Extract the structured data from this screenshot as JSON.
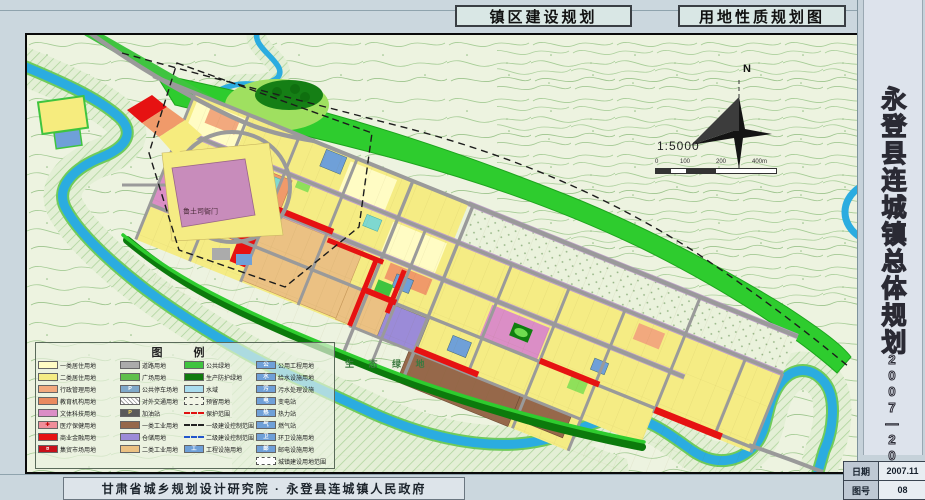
{
  "titles": {
    "primary": "镇区建设规划",
    "secondary": "用地性质规划图"
  },
  "side_panel": {
    "title": "永登县连城镇总体规划",
    "years": "2007—2020"
  },
  "info_table": {
    "date_label": "日期",
    "date_value": "2007.11",
    "no_label": "图号",
    "no_value": "08"
  },
  "footer": {
    "text": "甘肃省城乡规划设计研究院 · 永登县连城镇人民政府"
  },
  "map": {
    "labels": {
      "eco_green": "生 态 绿 地",
      "yamen": "鲁土司衙门",
      "north": "N",
      "scale_ratio": "1:5000"
    },
    "scale_ticks": [
      "0",
      "100",
      "200",
      "400m"
    ]
  },
  "legend": {
    "title": "图  例",
    "columns": [
      [
        {
          "label": "一类居住用地",
          "type": "swatch",
          "color": "#fffcc4"
        },
        {
          "label": "二类居住用地",
          "type": "swatch",
          "color": "#f5ec84"
        },
        {
          "label": "行政管理用地",
          "type": "swatch",
          "color": "#f2a97e"
        },
        {
          "label": "教育机构用地",
          "type": "swatch",
          "color": "#e98a5f"
        },
        {
          "label": "文体科技用地",
          "type": "swatch",
          "color": "#db8ec6"
        },
        {
          "label": "医疗保健用地",
          "type": "glyph",
          "color": "#ef8f9a",
          "glyph": "✚",
          "glyph_color": "#c00000"
        },
        {
          "label": "商业金融用地",
          "type": "swatch",
          "color": "#e61212"
        },
        {
          "label": "集贸市场用地",
          "type": "glyph",
          "color": "#c8101a",
          "glyph": "¤",
          "glyph_color": "#ffffff"
        }
      ],
      [
        {
          "label": "道路用地",
          "type": "swatch",
          "color": "#ababab"
        },
        {
          "label": "广场用地",
          "type": "swatch",
          "color": "#5fc04c"
        },
        {
          "label": "公共停车场地",
          "type": "glyph",
          "color": "#7fa8c9",
          "glyph": "P",
          "glyph_color": "#ffffff"
        },
        {
          "label": "对外交通用地",
          "type": "hatch",
          "color": "#9a9a9a"
        },
        {
          "label": "加油站",
          "type": "glyph",
          "color": "#5a5a5a",
          "glyph": "P",
          "glyph_color": "#ffe060"
        },
        {
          "label": "一类工业用地",
          "type": "swatch",
          "color": "#96684a"
        },
        {
          "label": "仓储用地",
          "type": "swatch",
          "color": "#9b8bd8"
        },
        {
          "label": "二类工业用地",
          "type": "swatch",
          "color": "#ebc183"
        }
      ],
      [
        {
          "label": "公共绿地",
          "type": "swatch",
          "color": "#3fc43f"
        },
        {
          "label": "生产防护绿地",
          "type": "swatch",
          "color": "#0e7a0e"
        },
        {
          "label": "水域",
          "type": "swatch",
          "color": "#a9dcef"
        },
        {
          "label": "预留用地",
          "type": "dashbox",
          "color": "#f2f5e6"
        },
        {
          "label": "保护范围",
          "type": "line-red"
        },
        {
          "label": "一级建设控制范围",
          "type": "line-dd"
        },
        {
          "label": "二级建设控制范围",
          "type": "line-blue"
        },
        {
          "label": "工程设施用地",
          "type": "glyph",
          "color": "#6fa0d8",
          "glyph": "工",
          "glyph_color": "#ffffff"
        }
      ],
      [
        {
          "label": "公用工程用地",
          "type": "glyph",
          "color": "#6fa0d8",
          "glyph": "公",
          "glyph_color": "#ffffff"
        },
        {
          "label": "给水设施用地",
          "type": "glyph",
          "color": "#6fa0d8",
          "glyph": "水",
          "glyph_color": "#ffffff"
        },
        {
          "label": "污水处理设施",
          "type": "glyph",
          "color": "#6fa0d8",
          "glyph": "污",
          "glyph_color": "#ffffff"
        },
        {
          "label": "变电站",
          "type": "glyph",
          "color": "#6fa0d8",
          "glyph": "电",
          "glyph_color": "#ffffff"
        },
        {
          "label": "热力站",
          "type": "glyph",
          "color": "#6fa0d8",
          "glyph": "热",
          "glyph_color": "#ffffff"
        },
        {
          "label": "燃气站",
          "type": "glyph",
          "color": "#6fa0d8",
          "glyph": "气",
          "glyph_color": "#ffffff"
        },
        {
          "label": "环卫设施用地",
          "type": "glyph",
          "color": "#6fa0d8",
          "glyph": "卫",
          "glyph_color": "#ffffff"
        },
        {
          "label": "邮电设施用地",
          "type": "glyph",
          "color": "#6fa0d8",
          "glyph": "邮",
          "glyph_color": "#ffffff"
        },
        {
          "label": "城镇建设用地范围",
          "type": "dashbox",
          "color": "#ffffff"
        }
      ]
    ]
  },
  "colors": {
    "page_bg": "#cbd7de",
    "map_bg": "#edf3e0",
    "river": "#2bace0",
    "public_green": "#3fc43f",
    "protect_green": "#0e7a0e",
    "residential": "#f5ec84",
    "commercial": "#e61212",
    "road": "#9a9a9a"
  }
}
